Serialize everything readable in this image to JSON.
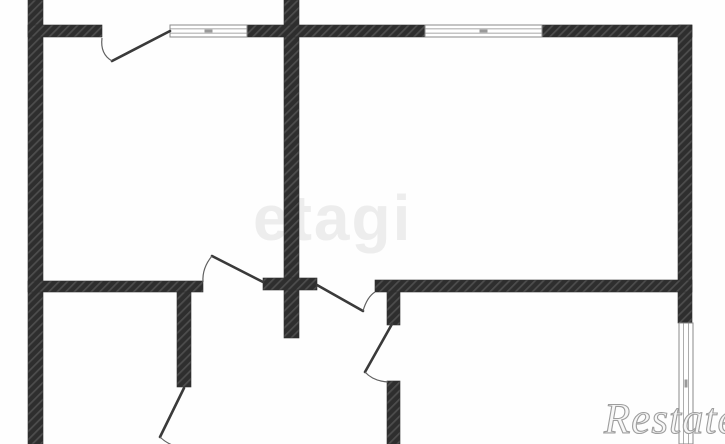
{
  "watermarks": {
    "center_text": "etagi",
    "corner_text": "Restate"
  },
  "plan": {
    "colors": {
      "wall_base": "#2e2e2e",
      "wall_hatch": "#4d4d4d",
      "door_line": "#3a3a3a",
      "door_arc": "#606060",
      "window_border": "#8a8a8a",
      "window_tick": "#9a9a9a",
      "wm_center": "#ededed",
      "wm_corner": "#9e9e9e"
    },
    "walls": [
      {
        "name": "exterior-wall-left",
        "x": 28,
        "y": 0,
        "w": 15,
        "h": 444
      },
      {
        "name": "partition-wall-center",
        "x": 284,
        "y": 0,
        "w": 15,
        "h": 338
      },
      {
        "name": "exterior-wall-top-left",
        "x": 28,
        "y": 25,
        "w": 74,
        "h": 12
      },
      {
        "name": "exterior-wall-top-middle",
        "x": 247,
        "y": 25,
        "w": 178,
        "h": 12
      },
      {
        "name": "exterior-wall-top-right",
        "x": 542,
        "y": 25,
        "w": 150,
        "h": 12
      },
      {
        "name": "exterior-wall-right",
        "x": 678,
        "y": 25,
        "w": 14,
        "h": 298
      },
      {
        "name": "partition-wall-mid-left",
        "x": 28,
        "y": 281,
        "w": 175,
        "h": 11
      },
      {
        "name": "partition-stub-center",
        "x": 263,
        "y": 278,
        "w": 54,
        "h": 12
      },
      {
        "name": "partition-wall-mid-right",
        "x": 375,
        "y": 280,
        "w": 317,
        "h": 12
      },
      {
        "name": "partition-wall-closet",
        "x": 177,
        "y": 292,
        "w": 14,
        "h": 95
      },
      {
        "name": "partition-wall-bath-upper",
        "x": 387,
        "y": 292,
        "w": 13,
        "h": 33
      },
      {
        "name": "partition-wall-bath-lower",
        "x": 387,
        "y": 381,
        "w": 13,
        "h": 63
      }
    ],
    "windows": [
      {
        "name": "window-top-left",
        "x": 170,
        "y": 25,
        "w": 77,
        "h": 12,
        "orientation": "horizontal"
      },
      {
        "name": "window-top-right",
        "x": 425,
        "y": 25,
        "w": 117,
        "h": 12,
        "orientation": "horizontal"
      },
      {
        "name": "window-right",
        "x": 679,
        "y": 323,
        "w": 14,
        "h": 121,
        "orientation": "vertical"
      }
    ],
    "doors": [
      {
        "name": "door-balcony-top-left",
        "leaf": [
          170,
          31,
          112,
          61
        ],
        "arc": "M102,38 Q100,54 112,61"
      },
      {
        "name": "door-room-left",
        "leaf": [
          263,
          282,
          212,
          256
        ],
        "arc": "M212,256 Q202,268 203,282"
      },
      {
        "name": "door-hall-center",
        "leaf": [
          317,
          285,
          363,
          311
        ],
        "arc": "M363,311 Q367,297 375,292"
      },
      {
        "name": "door-bath",
        "leaf": [
          392,
          324,
          365,
          372
        ],
        "arc": "M365,372 Q373,381 388,382"
      },
      {
        "name": "door-bottom",
        "leaf": [
          184,
          388,
          160,
          437
        ],
        "arc": "M160,437 Q167,444 178,447"
      }
    ]
  }
}
